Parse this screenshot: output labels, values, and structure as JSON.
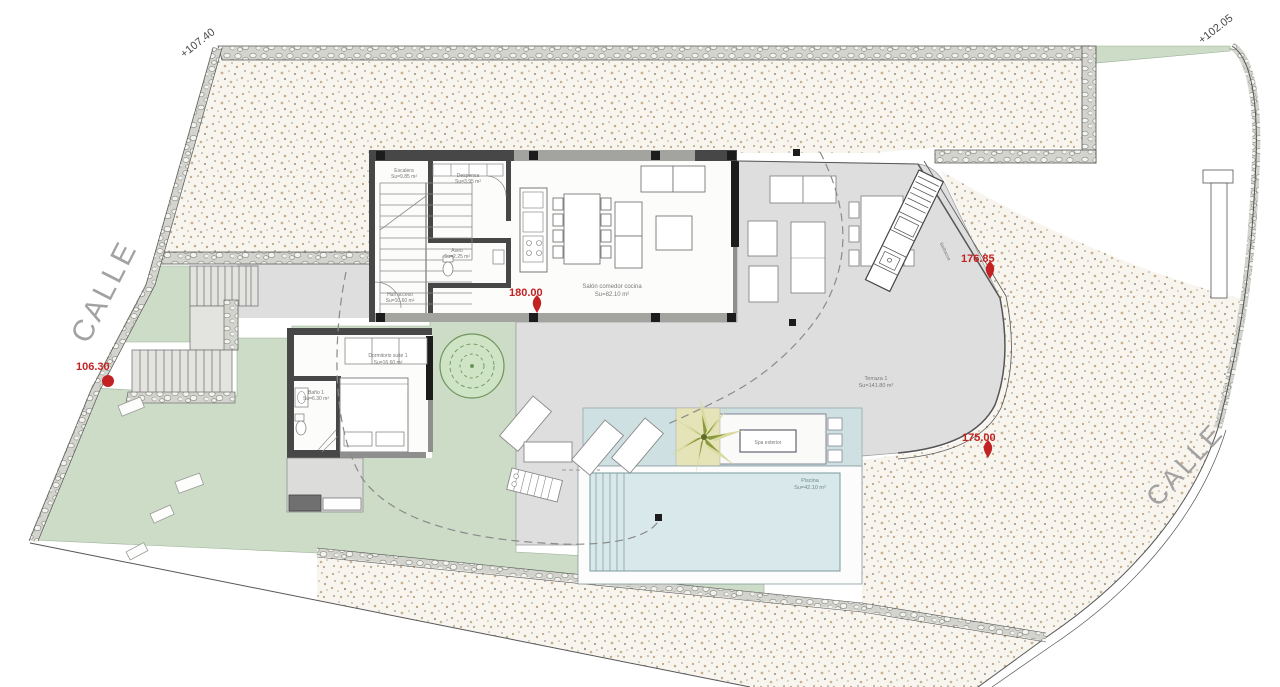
{
  "plan": {
    "streets": {
      "left": "CALLE",
      "right": "CALLE"
    },
    "levels": {
      "top_left": "+107.40",
      "top_right": "+102.05"
    },
    "spot_levels": [
      {
        "value": "106.30"
      },
      {
        "value": "180.00"
      },
      {
        "value": "176.85"
      },
      {
        "value": "175.00"
      }
    ],
    "rooms": [
      {
        "id": "escalera",
        "name": "Escalera",
        "area": "Su=9.85 m²"
      },
      {
        "id": "despensa",
        "name": "Despensa",
        "area": "Su=3.95 m²"
      },
      {
        "id": "aseo",
        "name": "Aseo",
        "area": "Su=2.25 m²"
      },
      {
        "id": "hall",
        "name": "Hall acceso",
        "area": "Su=10.60 m²"
      },
      {
        "id": "salon",
        "name": "Salón comedor cocina",
        "area": "Su=82.10 m²"
      },
      {
        "id": "dormitorio",
        "name": "Dormitorio suite 1",
        "area": "Su=16.60 m²"
      },
      {
        "id": "bano",
        "name": "Baño 1",
        "area": "Su=6.30 m²"
      },
      {
        "id": "terraza",
        "name": "Terraza 1",
        "area": "Su=141.80 m²"
      },
      {
        "id": "piscina",
        "name": "Piscina",
        "area": "Su=42.10 m²"
      },
      {
        "id": "spa",
        "name": "Spa exterior",
        "area": ""
      },
      {
        "id": "barbacoa",
        "name": "Barbacoa",
        "area": ""
      }
    ],
    "colors": {
      "spot_marker": "#c32222",
      "terrain": "#f8f5ef",
      "stone": "#d4d4ce",
      "green": "#ccdcc6",
      "terrace": "#dedede",
      "pool": "#d9e8ea",
      "deck": "#cfe0e3",
      "wall_dark": "#474747"
    }
  }
}
